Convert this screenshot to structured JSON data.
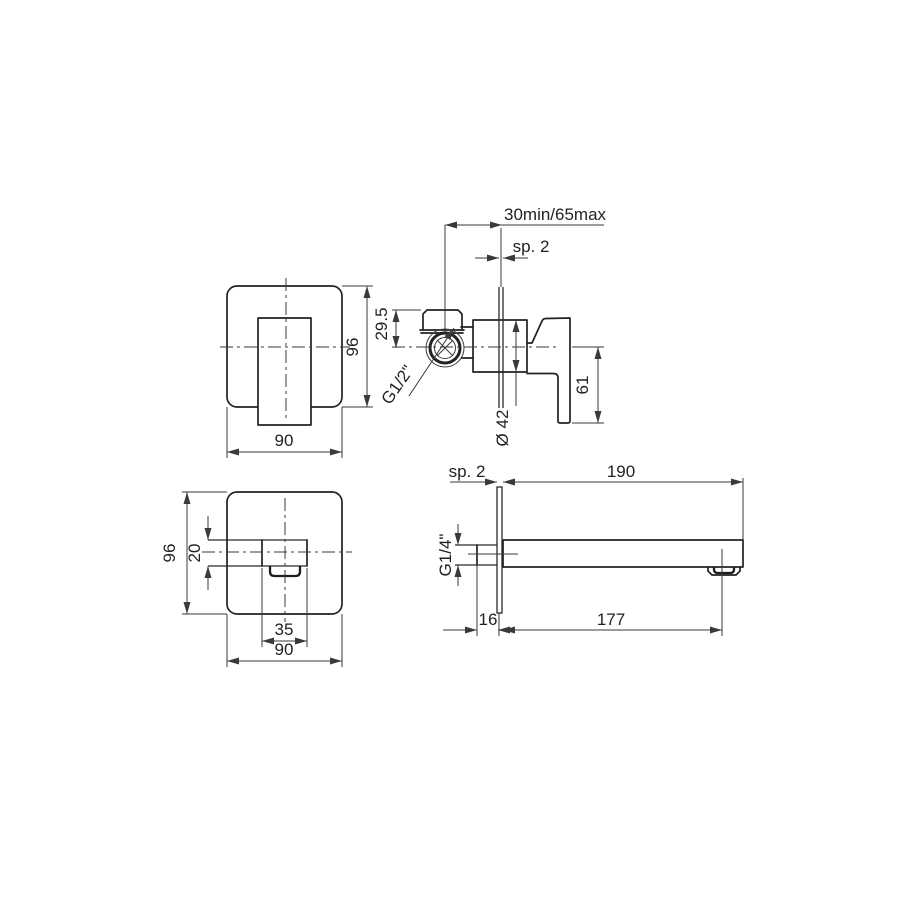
{
  "title": "Wall-mounted basin mixer – dimensional technical drawing",
  "colors": {
    "line": "#222222",
    "dim": "#3a3a3a",
    "background": "#ffffff"
  },
  "labels": {
    "front": {
      "width": "90",
      "height": "96"
    },
    "side": {
      "depth_range": "30min/65max",
      "plate_thickness": "sp. 2",
      "top_inlet_offset": "29.5",
      "inlet_thread": "G1/2\"",
      "body_diameter": "Ø 42",
      "handle_height": "61"
    },
    "spout_front": {
      "width": "90",
      "height": "96",
      "spout_height": "20",
      "spout_width": "35"
    },
    "spout_side": {
      "plate_thickness": "sp. 2",
      "length": "190",
      "inlet_thread": "G1/4\"",
      "wall_clearance": "16",
      "aerator_distance": "177"
    }
  }
}
